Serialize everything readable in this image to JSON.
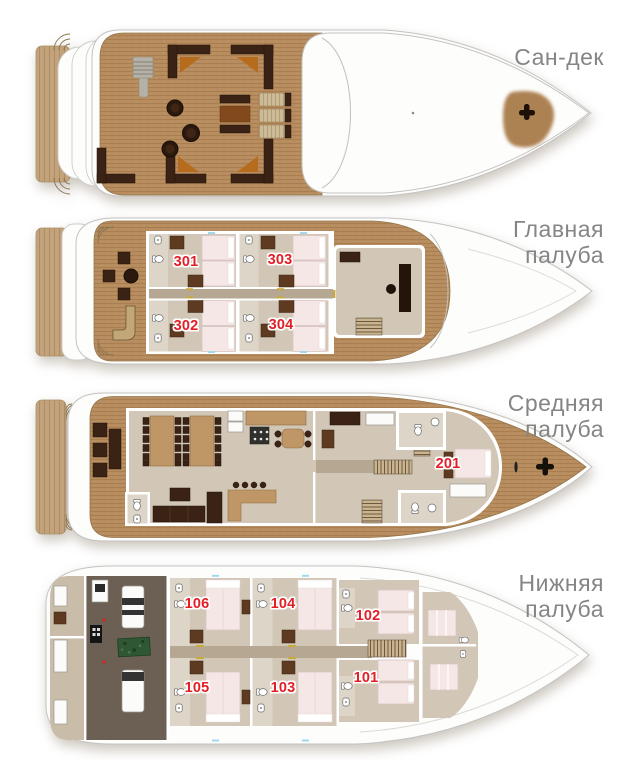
{
  "page": {
    "background": "#ffffff",
    "description": "Четыре плана палуб яхты"
  },
  "decks": [
    {
      "id": "sun-deck",
      "label": "Сан-дек",
      "label_lines": [
        "Сан-дек"
      ],
      "cabins": []
    },
    {
      "id": "main-deck",
      "label": "Главная палуба",
      "label_lines": [
        "Главная",
        "палуба"
      ],
      "cabins": [
        {
          "number": "301"
        },
        {
          "number": "303"
        },
        {
          "number": "302"
        },
        {
          "number": "304"
        }
      ]
    },
    {
      "id": "middle-deck",
      "label": "Средняя палуба",
      "label_lines": [
        "Средняя",
        "палуба"
      ],
      "cabins": [
        {
          "number": "201"
        }
      ]
    },
    {
      "id": "lower-deck",
      "label": "Нижняя палуба",
      "label_lines": [
        "Нижняя",
        "палуба"
      ],
      "cabins": [
        {
          "number": "106"
        },
        {
          "number": "104"
        },
        {
          "number": "102"
        },
        {
          "number": "105"
        },
        {
          "number": "103"
        },
        {
          "number": "101"
        }
      ]
    }
  ],
  "colors": {
    "teak": "#b78c5e",
    "teak_stripe": "#a97f52",
    "platform": "#c2a37b",
    "hull_white": "#fdfdfc",
    "hull_outline": "#c4c3c1",
    "interior_floor": "#d2c7b7",
    "bathroom_floor": "#ddd5c8",
    "corridor": "#b5a791",
    "furniture_dark": "#3a2214",
    "wardrobe": "#5d3a20",
    "cushion_orange": "#b76b1d",
    "bed": "#f5e7e5",
    "engine_room_floor": "#6c6054",
    "crew_floor": "#c9bda9",
    "generator_green": "#2f5733",
    "porthole_blue": "#9fd9ee",
    "door_gold": "#c9a83c",
    "cabin_number_red": "#e31e26",
    "label_gray": "#858585"
  },
  "icons": {
    "anchor-winch-icon": "dark cross-shaped winch",
    "toilet-icon": "white oval WC bowl with tank",
    "sink-icon": "white rounded basin",
    "stairs-icon": "striped stair treads",
    "round-table-icon": "dark round table",
    "sun-lounger-icon": "striped deck lounger",
    "stove-icon": "dark hob with six burners"
  }
}
